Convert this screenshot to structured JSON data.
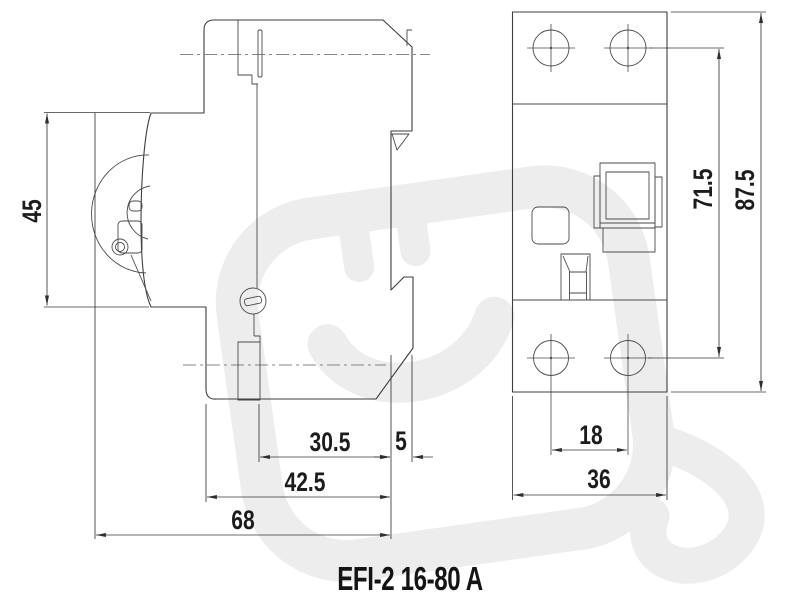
{
  "drawing": {
    "title": "EFI-2 16-80 A",
    "dimensions": {
      "d45": "45",
      "d30_5": "30.5",
      "d5": "5",
      "d42_5": "42.5",
      "d68": "68",
      "d18": "18",
      "d36": "36",
      "d71_5": "71.5",
      "d87_5": "87.5"
    },
    "watermark_icon": "plug-logo",
    "colors": {
      "line": "#3d3d3d",
      "dimension_text": "#1c1c1c",
      "watermark": "#ededed",
      "background": "#ffffff"
    }
  }
}
